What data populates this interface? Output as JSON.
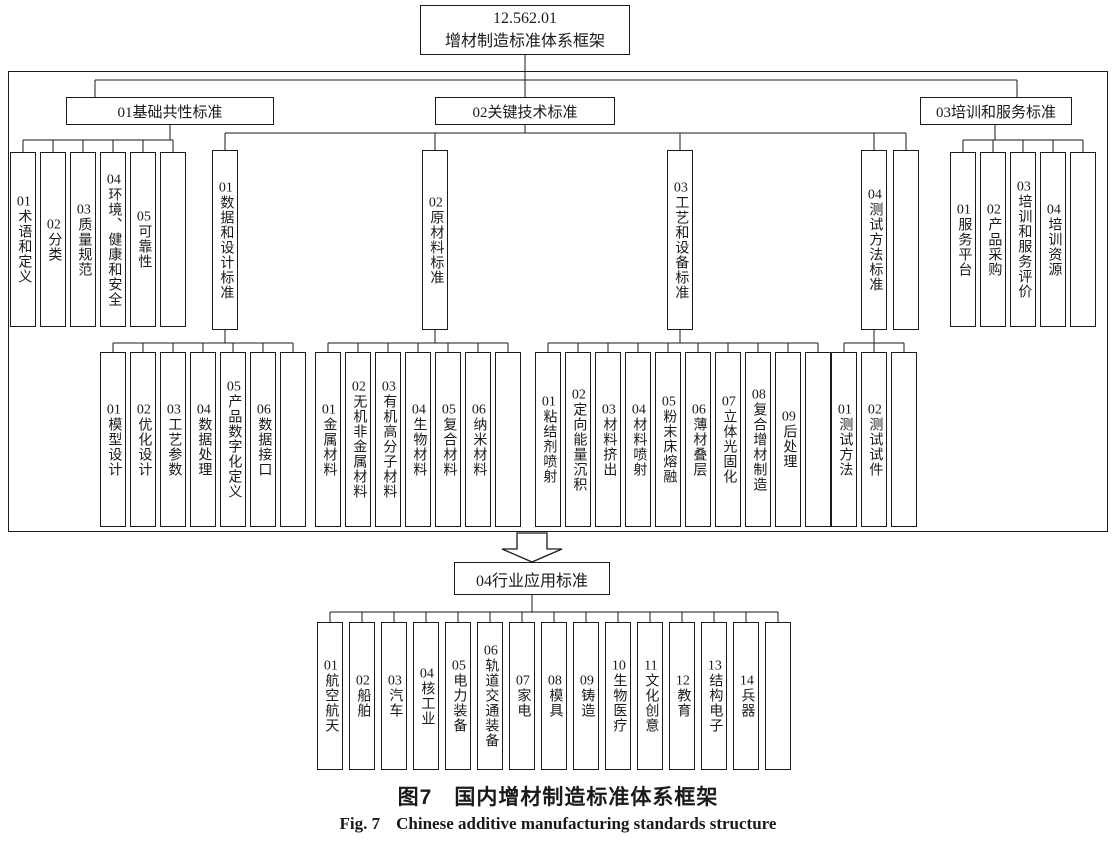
{
  "colors": {
    "ink": "#1a1a1a",
    "background": "#ffffff"
  },
  "root": {
    "code": "12.562.01",
    "title": "增材制造标准体系框架"
  },
  "branches": [
    {
      "label": "01基础共性标准",
      "children": [
        {
          "num": "01",
          "label": "术语和定义"
        },
        {
          "num": "02",
          "label": "分类"
        },
        {
          "num": "03",
          "label": "质量规范"
        },
        {
          "num": "04",
          "label": "环境、健康和安全"
        },
        {
          "num": "05",
          "label": "可靠性"
        },
        {
          "num": "",
          "label": ""
        }
      ]
    },
    {
      "label": "02关键技术标准",
      "subgroups": [
        {
          "num": "01",
          "label": "数据和设计标准",
          "children": [
            {
              "num": "01",
              "label": "模型设计"
            },
            {
              "num": "02",
              "label": "优化设计"
            },
            {
              "num": "03",
              "label": "工艺参数"
            },
            {
              "num": "04",
              "label": "数据处理"
            },
            {
              "num": "05",
              "label": "产品数字化定义"
            },
            {
              "num": "06",
              "label": "数据接口"
            },
            {
              "num": "",
              "label": ""
            }
          ]
        },
        {
          "num": "02",
          "label": "原材料标准",
          "children": [
            {
              "num": "01",
              "label": "金属材料"
            },
            {
              "num": "02",
              "label": "无机非金属材料"
            },
            {
              "num": "03",
              "label": "有机高分子材料"
            },
            {
              "num": "04",
              "label": "生物材料"
            },
            {
              "num": "05",
              "label": "复合材料"
            },
            {
              "num": "06",
              "label": "纳米材料"
            },
            {
              "num": "",
              "label": ""
            }
          ]
        },
        {
          "num": "03",
          "label": "工艺和设备标准",
          "children": [
            {
              "num": "01",
              "label": "粘结剂喷射"
            },
            {
              "num": "02",
              "label": "定向能量沉积"
            },
            {
              "num": "03",
              "label": "材料挤出"
            },
            {
              "num": "04",
              "label": "材料喷射"
            },
            {
              "num": "05",
              "label": "粉末床熔融"
            },
            {
              "num": "06",
              "label": "薄材叠层"
            },
            {
              "num": "07",
              "label": "立体光固化"
            },
            {
              "num": "08",
              "label": "复合增材制造"
            },
            {
              "num": "09",
              "label": "后处理"
            },
            {
              "num": "",
              "label": ""
            }
          ]
        },
        {
          "num": "04",
          "label": "测试方法标准",
          "children": [
            {
              "num": "01",
              "label": "测试方法"
            },
            {
              "num": "02",
              "label": "测试试件"
            },
            {
              "num": "",
              "label": ""
            }
          ]
        },
        {
          "num": "",
          "label": "",
          "children": []
        }
      ]
    },
    {
      "label": "03培训和服务标准",
      "children": [
        {
          "num": "01",
          "label": "服务平台"
        },
        {
          "num": "02",
          "label": "产品采购"
        },
        {
          "num": "03",
          "label": "培训和服务评价"
        },
        {
          "num": "04",
          "label": "培训资源"
        },
        {
          "num": "",
          "label": ""
        }
      ]
    }
  ],
  "industry": {
    "label": "04行业应用标准",
    "children": [
      {
        "num": "01",
        "label": "航空航天"
      },
      {
        "num": "02",
        "label": "船舶"
      },
      {
        "num": "03",
        "label": "汽车"
      },
      {
        "num": "04",
        "label": "核工业"
      },
      {
        "num": "05",
        "label": "电力装备"
      },
      {
        "num": "06",
        "label": "轨道交通装备"
      },
      {
        "num": "07",
        "label": "家电"
      },
      {
        "num": "08",
        "label": "模具"
      },
      {
        "num": "09",
        "label": "铸造"
      },
      {
        "num": "10",
        "label": "生物医疗"
      },
      {
        "num": "11",
        "label": "文化创意"
      },
      {
        "num": "12",
        "label": "教育"
      },
      {
        "num": "13",
        "label": "结构电子"
      },
      {
        "num": "14",
        "label": "兵器"
      },
      {
        "num": "",
        "label": ""
      }
    ]
  },
  "captions": {
    "zh_tag": "图7",
    "zh_title": "国内增材制造标准体系框架",
    "en_tag": "Fig. 7",
    "en_title": "Chinese additive manufacturing standards structure"
  }
}
